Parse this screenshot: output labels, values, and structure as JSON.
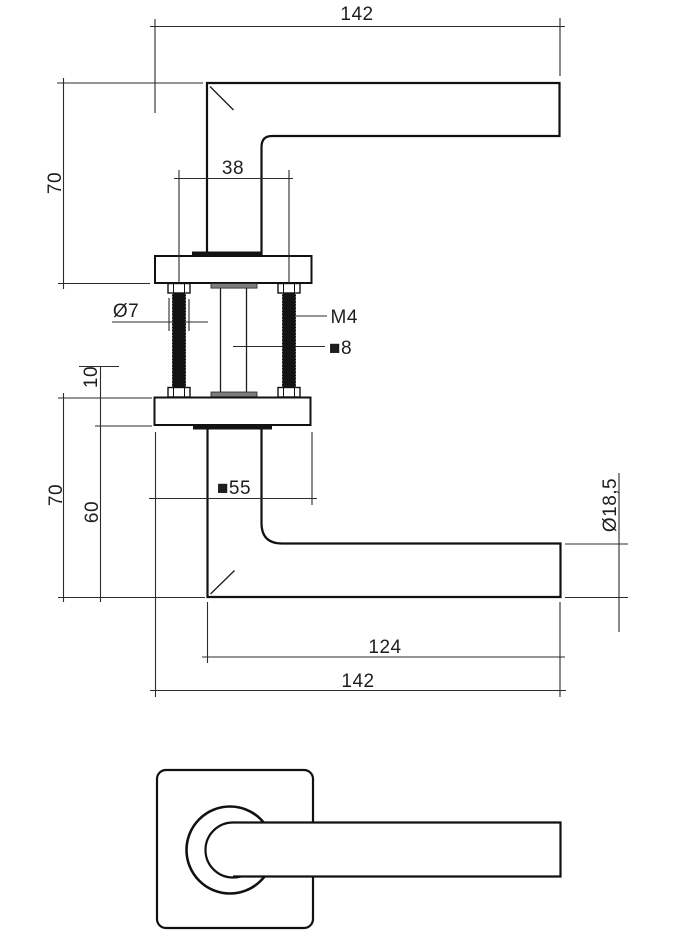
{
  "view_top": {
    "total_length": "142",
    "height": "70",
    "screw_spacing": "38"
  },
  "fasteners": {
    "screw_diameter": "Ø7",
    "thread": "M4",
    "spindle_size": "■8"
  },
  "view_side": {
    "rosette_thickness": "10",
    "height": "70",
    "offset": "60",
    "rosette_size": "■55",
    "grip_diameter": "Ø18,5",
    "grip_length": "124",
    "total_length": "142"
  }
}
